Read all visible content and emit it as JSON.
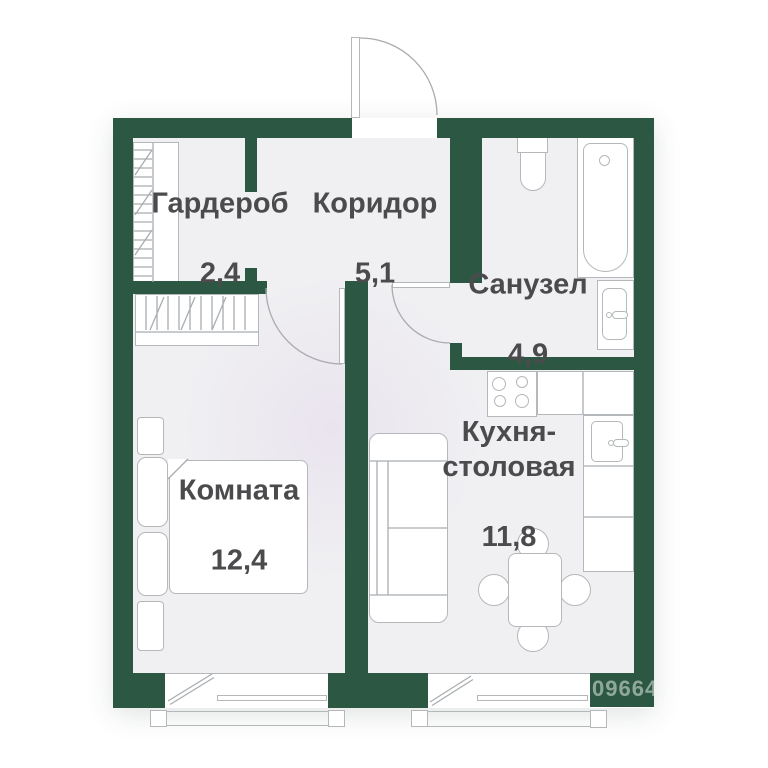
{
  "page": {
    "background": "#ffffff"
  },
  "plan": {
    "title": "1-room apartment floor plan",
    "rooms": [
      {
        "id": "garderob",
        "name": "Гардероб",
        "area": "2,4"
      },
      {
        "id": "koridor",
        "name": "Коридор",
        "area": "5,1"
      },
      {
        "id": "sanuzel",
        "name": "Санузел",
        "area": "4,9"
      },
      {
        "id": "kuhnya",
        "name": "Кухня-\nстоловая",
        "area": "11,8"
      },
      {
        "id": "komnata",
        "name": "Комната",
        "area": "12,4"
      }
    ],
    "watermark": "09664",
    "colors": {
      "wall": "#2c5843",
      "floor": "#f0f0f2",
      "line": "#b4b8ba",
      "svgline": "#a9adb0",
      "label": "#4b4b4e",
      "wm": "rgba(228,235,229,0.55)"
    },
    "fixtures": [
      "entrance-door",
      "closet-shelves",
      "wardrobe",
      "interior-door",
      "bed",
      "pillow",
      "nightstand",
      "toilet",
      "bathtub",
      "washbasin",
      "stove",
      "kitchen-sink",
      "counter",
      "sofa",
      "dining-table",
      "chair",
      "balcony-window",
      "balcony-railing"
    ]
  }
}
